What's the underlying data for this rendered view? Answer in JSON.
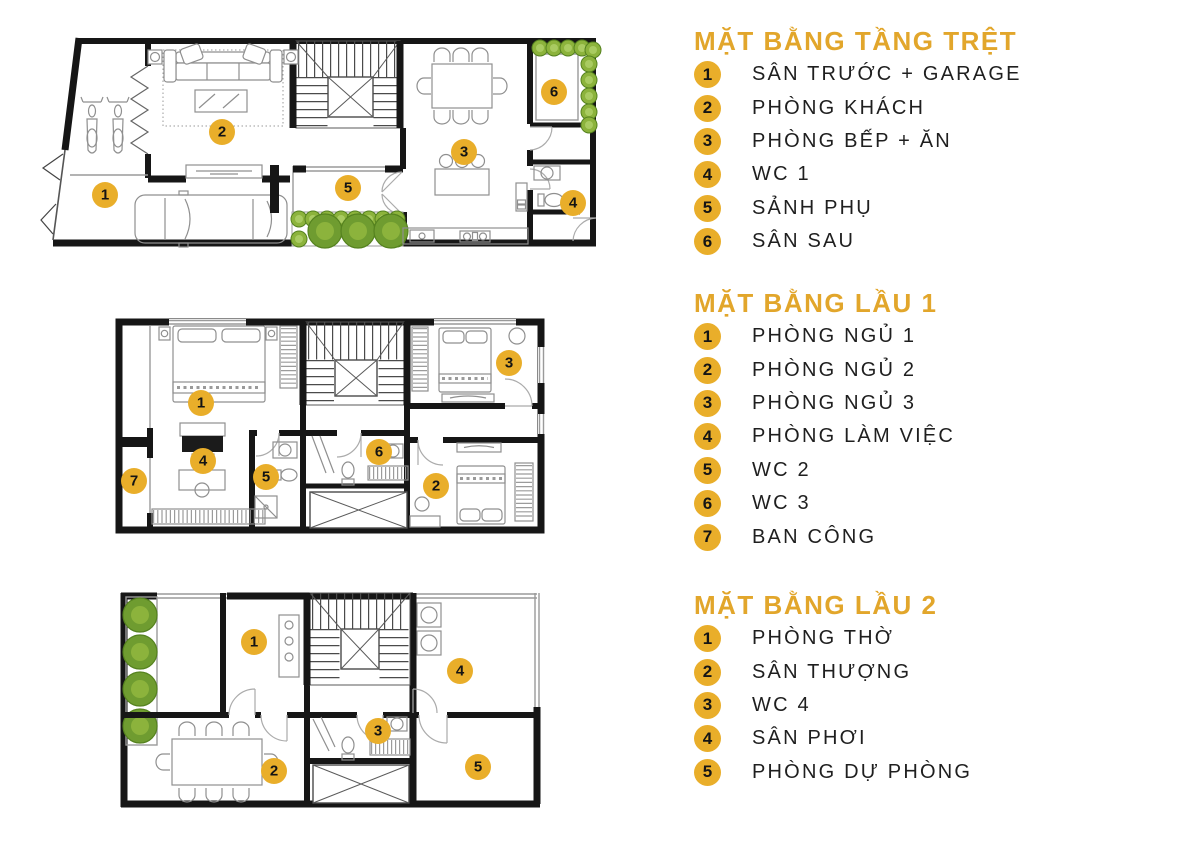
{
  "colors": {
    "accent": "#E9AE2A",
    "accent_title": "#E2A62B",
    "wall": "#161616",
    "furniture": "#8F8F8F",
    "thin": "#9A9A9A",
    "door": "#ABABAB",
    "plant": "#8CB33C",
    "plant_dark": "#55821F",
    "plant_inner": "#A9CB61",
    "tree_big": "#6F9C30",
    "text": "#1F1F1F"
  },
  "plans": [
    {
      "name": "ground-floor",
      "badges": [
        {
          "n": "1"
        },
        {
          "n": "2"
        },
        {
          "n": "3"
        },
        {
          "n": "4"
        },
        {
          "n": "5"
        },
        {
          "n": "6"
        }
      ]
    },
    {
      "name": "floor-1",
      "badges": [
        {
          "n": "1"
        },
        {
          "n": "2"
        },
        {
          "n": "3"
        },
        {
          "n": "4"
        },
        {
          "n": "5"
        },
        {
          "n": "6"
        },
        {
          "n": "7"
        }
      ]
    },
    {
      "name": "floor-2",
      "badges": [
        {
          "n": "1"
        },
        {
          "n": "2"
        },
        {
          "n": "3"
        },
        {
          "n": "4"
        },
        {
          "n": "5"
        }
      ]
    }
  ],
  "legends": [
    {
      "title": "MẶT BẰNG TẦNG TRỆT",
      "items": [
        {
          "num": "1",
          "label": "SÂN TRƯỚC + GARAGE"
        },
        {
          "num": "2",
          "label": "PHÒNG KHÁCH"
        },
        {
          "num": "3",
          "label": "PHÒNG BẾP + ĂN"
        },
        {
          "num": "4",
          "label": "WC 1"
        },
        {
          "num": "5",
          "label": "SẢNH PHỤ"
        },
        {
          "num": "6",
          "label": "SÂN SAU"
        }
      ]
    },
    {
      "title": "MẶT BẰNG LẦU 1",
      "items": [
        {
          "num": "1",
          "label": "PHÒNG NGỦ 1"
        },
        {
          "num": "2",
          "label": "PHÒNG NGỦ 2"
        },
        {
          "num": "3",
          "label": "PHÒNG NGỦ 3"
        },
        {
          "num": "4",
          "label": "PHÒNG LÀM VIỆC"
        },
        {
          "num": "5",
          "label": "WC 2"
        },
        {
          "num": "6",
          "label": "WC 3"
        },
        {
          "num": "7",
          "label": "BAN CÔNG"
        }
      ]
    },
    {
      "title": "MẶT BẰNG LẦU 2",
      "items": [
        {
          "num": "1",
          "label": "PHÒNG THỜ"
        },
        {
          "num": "2",
          "label": "SÂN THƯỢNG"
        },
        {
          "num": "3",
          "label": "WC 4"
        },
        {
          "num": "4",
          "label": "SÂN PHƠI"
        },
        {
          "num": "5",
          "label": "PHÒNG DỰ PHÒNG"
        }
      ]
    }
  ]
}
